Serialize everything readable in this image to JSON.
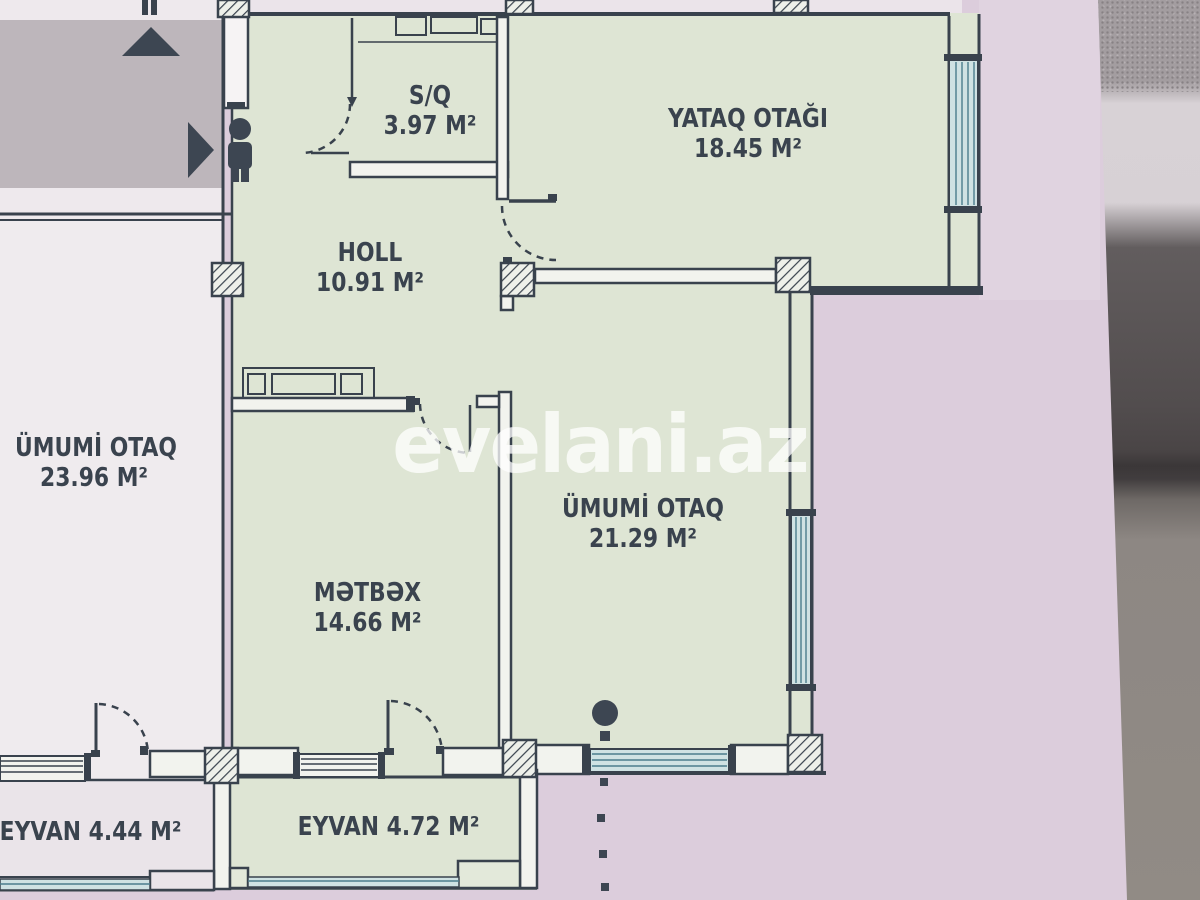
{
  "plan": {
    "watermark": "evelani.az",
    "rooms": {
      "sq": {
        "name": "S/Q",
        "area": "3.97 M²"
      },
      "yataq_otagi": {
        "name": "YATAQ OTAĞI",
        "area": "18.45 M²"
      },
      "holl": {
        "name": "HOLL",
        "area": "10.91 M²"
      },
      "umumi_otaq_left": {
        "name": "ÜMUMİ OTAQ",
        "area": "23.96 M²"
      },
      "umumi_otaq_main": {
        "name": "ÜMUMİ OTAQ",
        "area": "21.29 M²"
      },
      "metbex": {
        "name": "MƏTBƏX",
        "area": "14.66 M²"
      },
      "eyvan_left": {
        "label": "EYVAN 4.44 M²"
      },
      "eyvan_center": {
        "label": "EYVAN 4.72 M²"
      }
    },
    "colors": {
      "paper_pink": "#dccddc",
      "apartment_green": "#dee5d4",
      "neighbor_white": "#efebee",
      "corridor_gray": "#bdb6bb",
      "wall_ink": "#39424d",
      "window_teal_fill": "#cfe2e3",
      "window_teal_stripe": "#4b7d8c",
      "watermark_white": "rgba(255,255,255,0.75)"
    }
  }
}
